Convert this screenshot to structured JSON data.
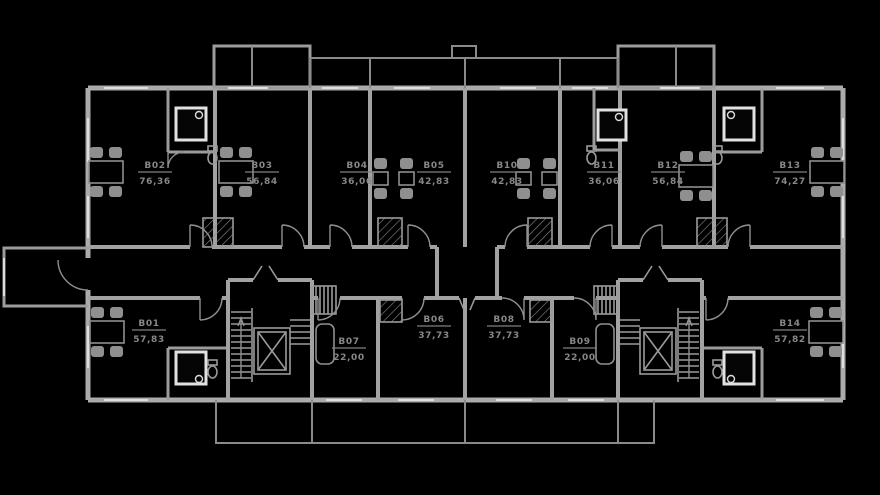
{
  "plan": {
    "type": "residential-floor-plan",
    "background_color": "#000000",
    "wall_color": "#ababab",
    "fixture_color": "#e2e2e2",
    "label_color": "#878787",
    "apartments": [
      {
        "number": "B02",
        "area": "76,36",
        "x": 155,
        "y": 172
      },
      {
        "number": "B03",
        "area": "56,84",
        "x": 262,
        "y": 172
      },
      {
        "number": "B04",
        "area": "36,06",
        "x": 357,
        "y": 172
      },
      {
        "number": "B05",
        "area": "42,83",
        "x": 434,
        "y": 172
      },
      {
        "number": "B10",
        "area": "42,83",
        "x": 507,
        "y": 172
      },
      {
        "number": "B11",
        "area": "36,06",
        "x": 604,
        "y": 172
      },
      {
        "number": "B12",
        "area": "56,84",
        "x": 668,
        "y": 172
      },
      {
        "number": "B13",
        "area": "74,27",
        "x": 790,
        "y": 172
      },
      {
        "number": "B01",
        "area": "57,83",
        "x": 149,
        "y": 330
      },
      {
        "number": "B07",
        "area": "22,00",
        "x": 349,
        "y": 348
      },
      {
        "number": "B06",
        "area": "37,73",
        "x": 434,
        "y": 326
      },
      {
        "number": "B08",
        "area": "37,73",
        "x": 504,
        "y": 326
      },
      {
        "number": "B09",
        "area": "22,00",
        "x": 580,
        "y": 348
      },
      {
        "number": "B14",
        "area": "57,82",
        "x": 790,
        "y": 330
      }
    ]
  }
}
